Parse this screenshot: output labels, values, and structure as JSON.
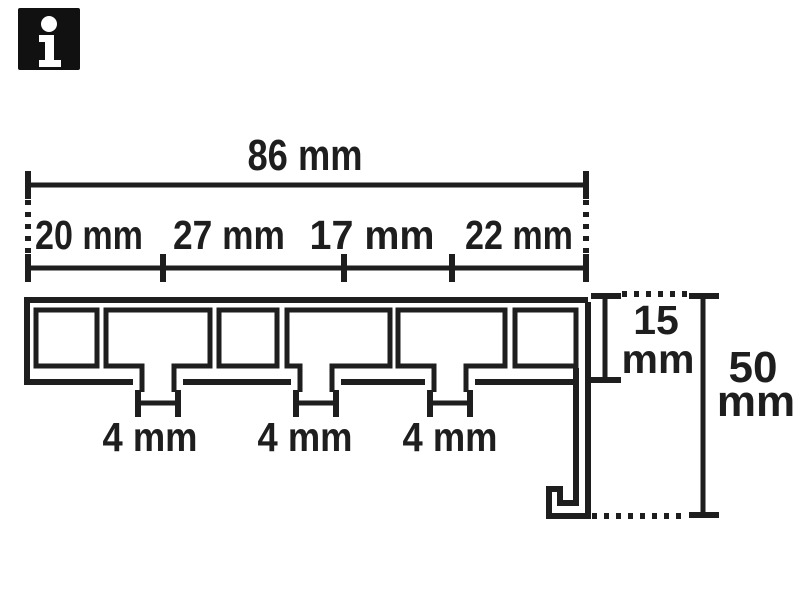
{
  "info_badge": {
    "glyph": "i"
  },
  "dims": {
    "total": "86 mm",
    "segments": [
      "20 mm",
      "27 mm",
      "17 mm",
      "22 mm"
    ],
    "slots": [
      "4 mm",
      "4 mm",
      "4 mm"
    ],
    "inner_height": {
      "value": "15",
      "unit": "mm"
    },
    "outer_height": {
      "value": "50",
      "unit": "mm"
    }
  },
  "colors": {
    "ink": "#1e1e1e",
    "background": "#ffffff",
    "badge_bg": "#111111",
    "badge_fg": "#ffffff"
  }
}
